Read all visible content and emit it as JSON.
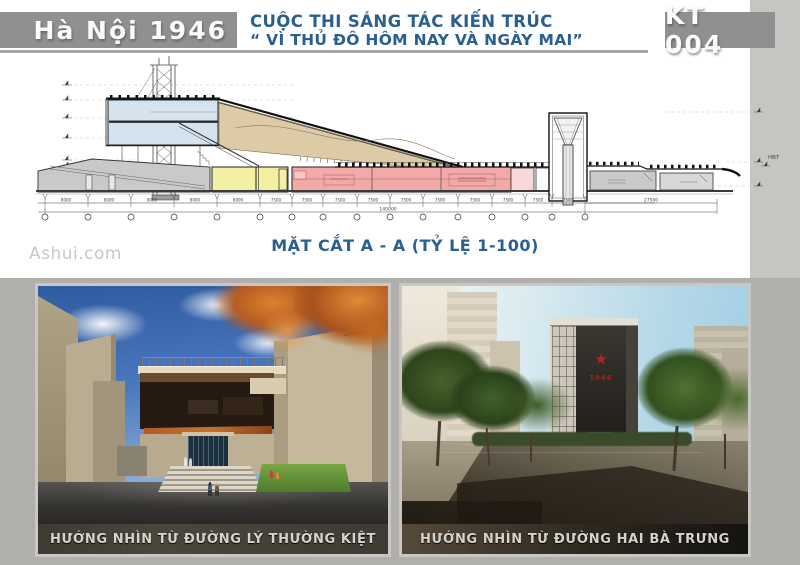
{
  "page": {
    "background": "#b1afac",
    "board": "#ffffff",
    "side_band": "#c6c5c2",
    "banner_gray": "#909090",
    "accent_blue": "#2a608f"
  },
  "header": {
    "event_title": "Hà Nội 1946",
    "competition_line1": "CUỘC THI SÁNG TÁC KIẾN TRÚC",
    "competition_line2": "“ VÌ THỦ ĐÔ HÔM NAY VÀ NGÀY MAI”",
    "entry_code": "KT 004"
  },
  "drawing": {
    "caption": "MẶT CẮT  A - A (TỶ LỆ 1-100)",
    "level_ref": "HBT",
    "dim_8000": "8000",
    "dim_7500": "7500",
    "dim_27500": "27500",
    "dim_total": "140000"
  },
  "watermark": "Ashui.com",
  "photos": [
    {
      "caption": "HƯỚNG NHÌN TỪ ĐƯỜNG LÝ THƯỜNG KIỆT"
    },
    {
      "caption": "HƯỚNG NHÌN TỪ ĐƯỜNG HAI BÀ TRƯNG",
      "star_icon": "★",
      "tower_year": "1946"
    }
  ]
}
